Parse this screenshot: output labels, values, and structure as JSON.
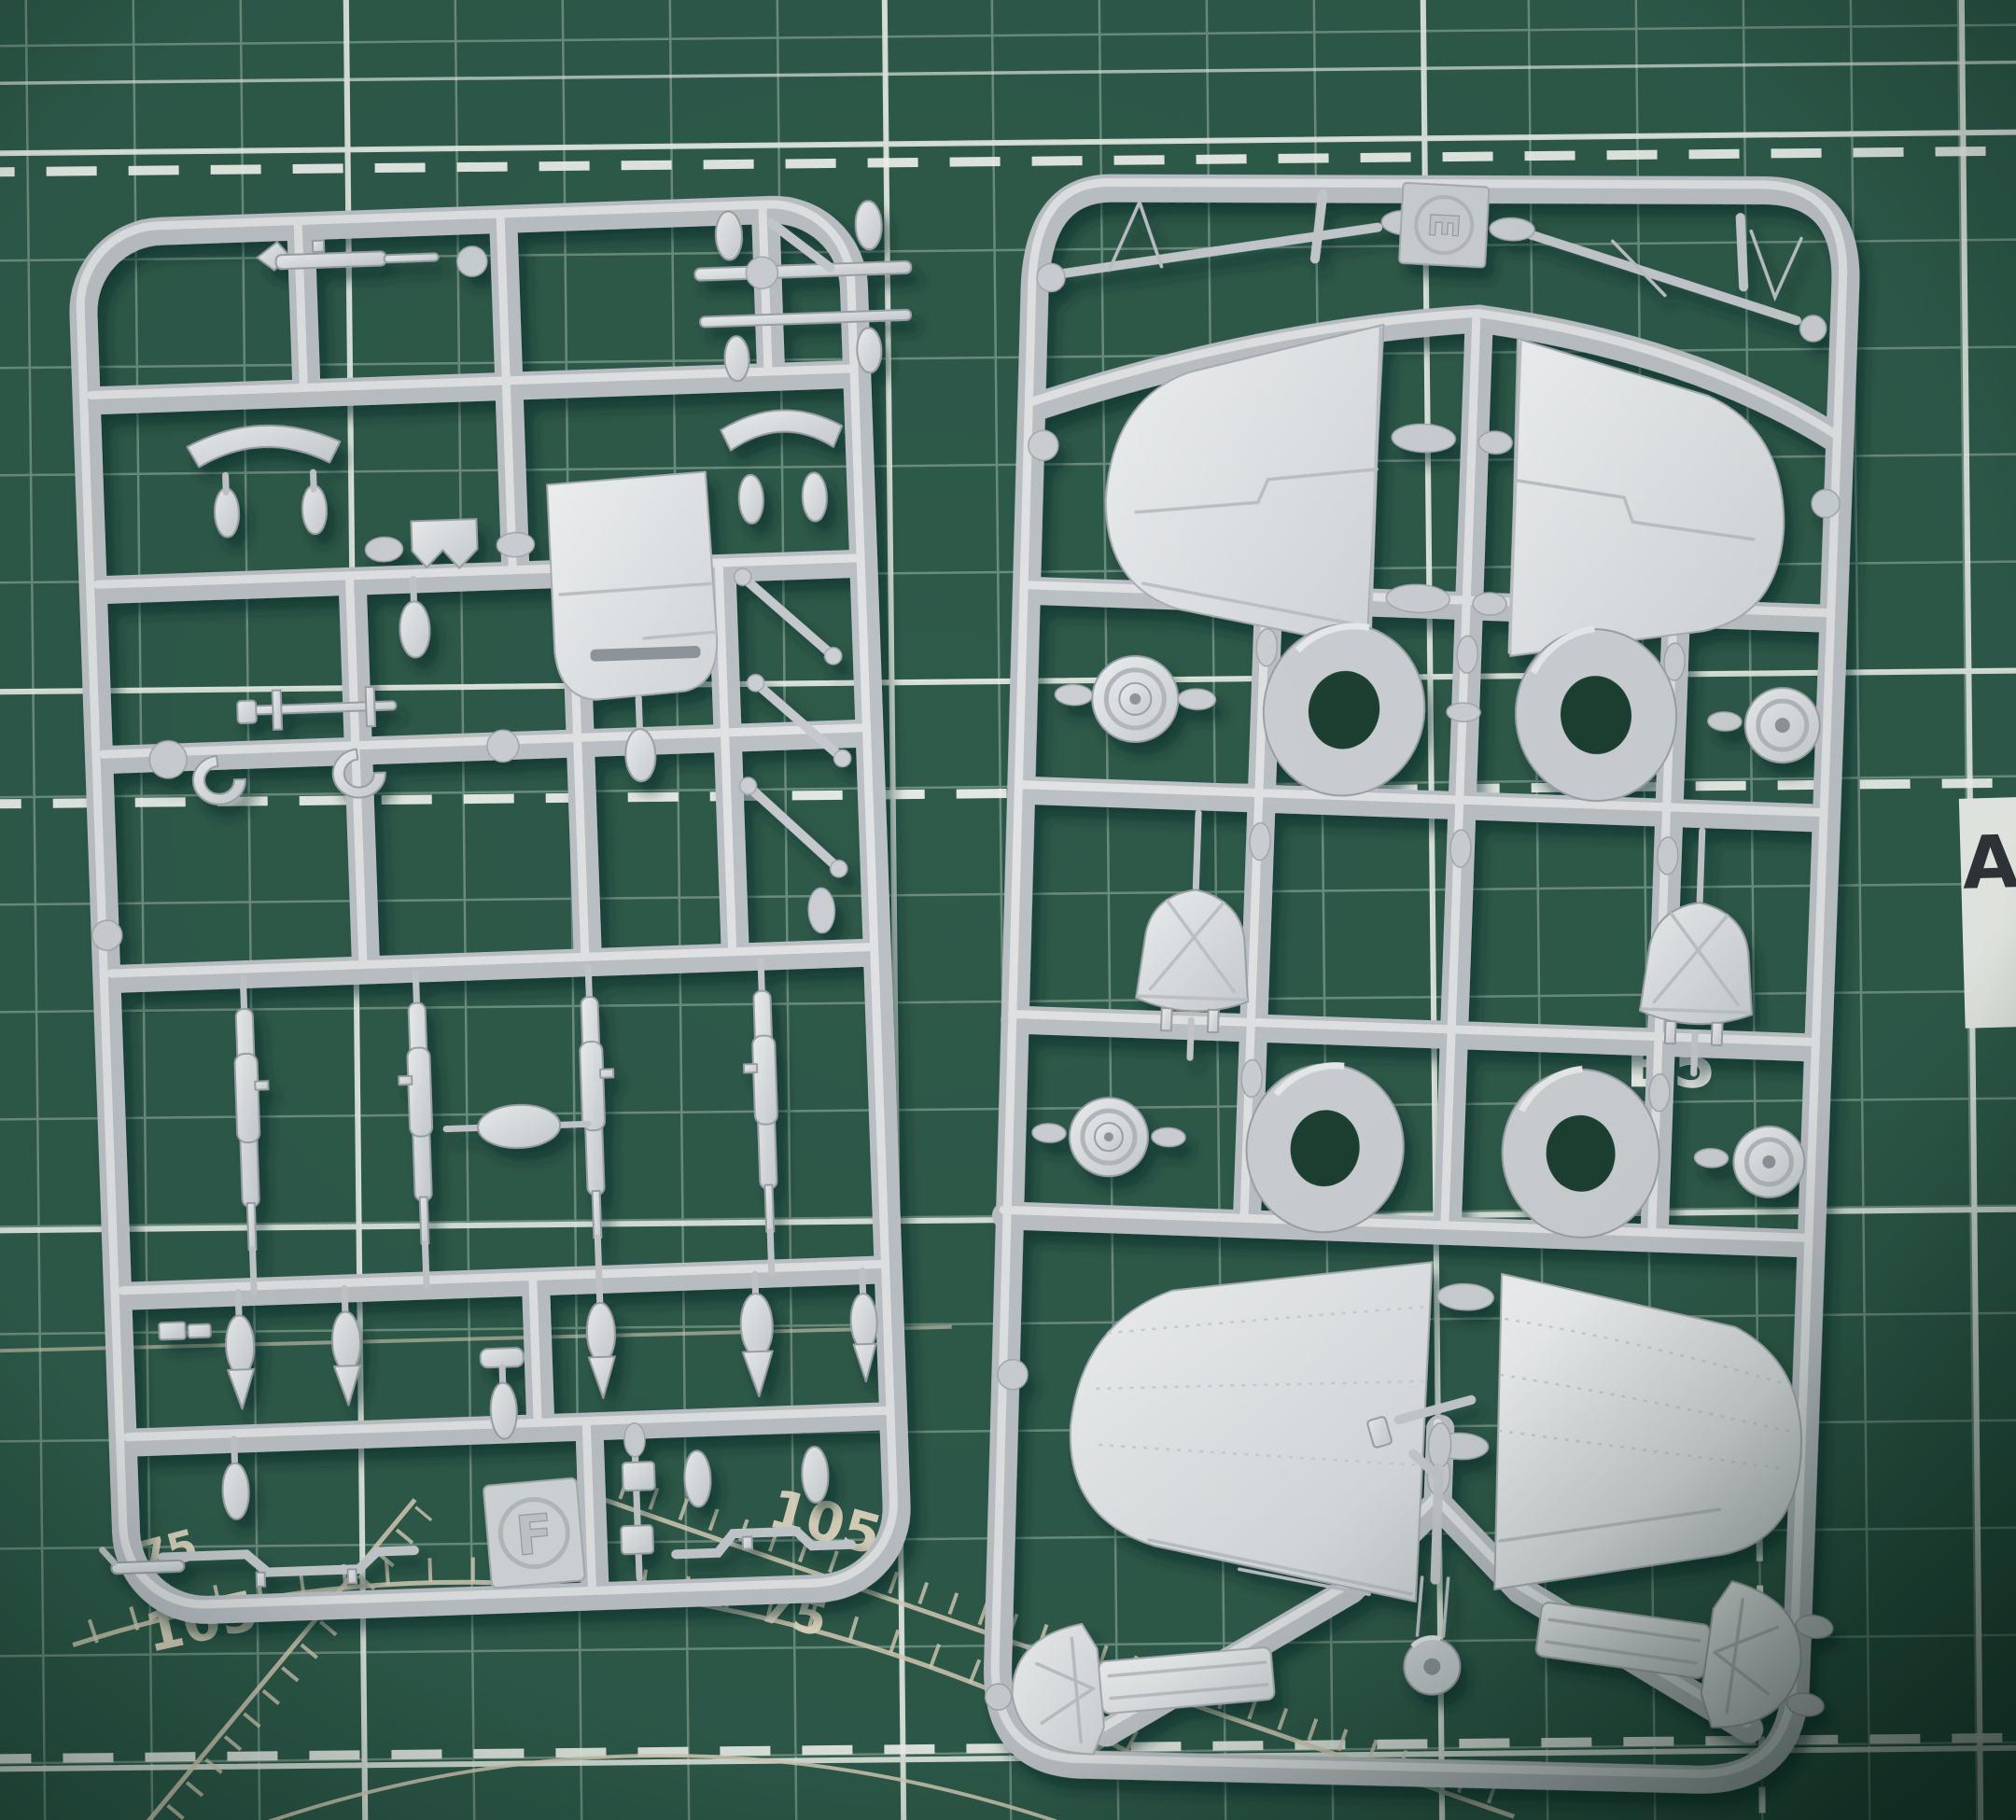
{
  "scene": {
    "type": "photograph",
    "subject": "Two light-gray plastic model-kit sprues (runner frames E and F with aircraft parts) lying side by side on a dark green self-healing cutting mat",
    "camera": "top-down"
  },
  "mat": {
    "base_color": "#2e5a4a",
    "fine_grid_color": "#cfe0d4",
    "major_grid_color": "#eef3ec",
    "dash_color": "#f3f6ef",
    "guide_color": "#dcd2bd",
    "labels": {
      "angle_75_left": "75",
      "angle_105_left": "105",
      "angle_105_mid": "105",
      "angle_75_mid": "75",
      "angle_60": "60",
      "size_b5": "B5",
      "size_a": "A"
    }
  },
  "sprues": {
    "plastic_color": "#c9cdd1",
    "part_color": "#d8dbde",
    "left": {
      "tag": "F"
    },
    "right": {
      "tag": "E"
    }
  }
}
